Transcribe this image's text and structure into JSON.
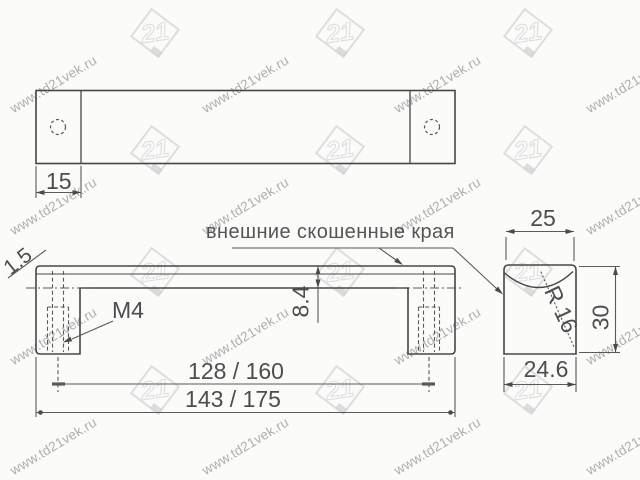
{
  "page": {
    "background": "#fbfbfa"
  },
  "colors": {
    "outline": "#474747",
    "thin_line": "#5a5a5a",
    "text": "#4d4d4d",
    "watermark_text": "#a8a8a8",
    "watermark_logo": "#dedede"
  },
  "drawing": {
    "annotation_bevel_edges": "внешние скошенные края",
    "top_view": {
      "end_cap_width": "15"
    },
    "front_view": {
      "bevel_thickness": "1.5",
      "top_bar_height": "8.4",
      "thread_label": "M4",
      "hole_spacing": "128 / 160",
      "overall_length": "143 / 175"
    },
    "side_view": {
      "top_width": "25",
      "groove_radius": "R 16",
      "height": "30",
      "bottom_width": "24.6"
    }
  },
  "watermark": {
    "text": "www.td21vek.ru",
    "logo_text": "21"
  }
}
